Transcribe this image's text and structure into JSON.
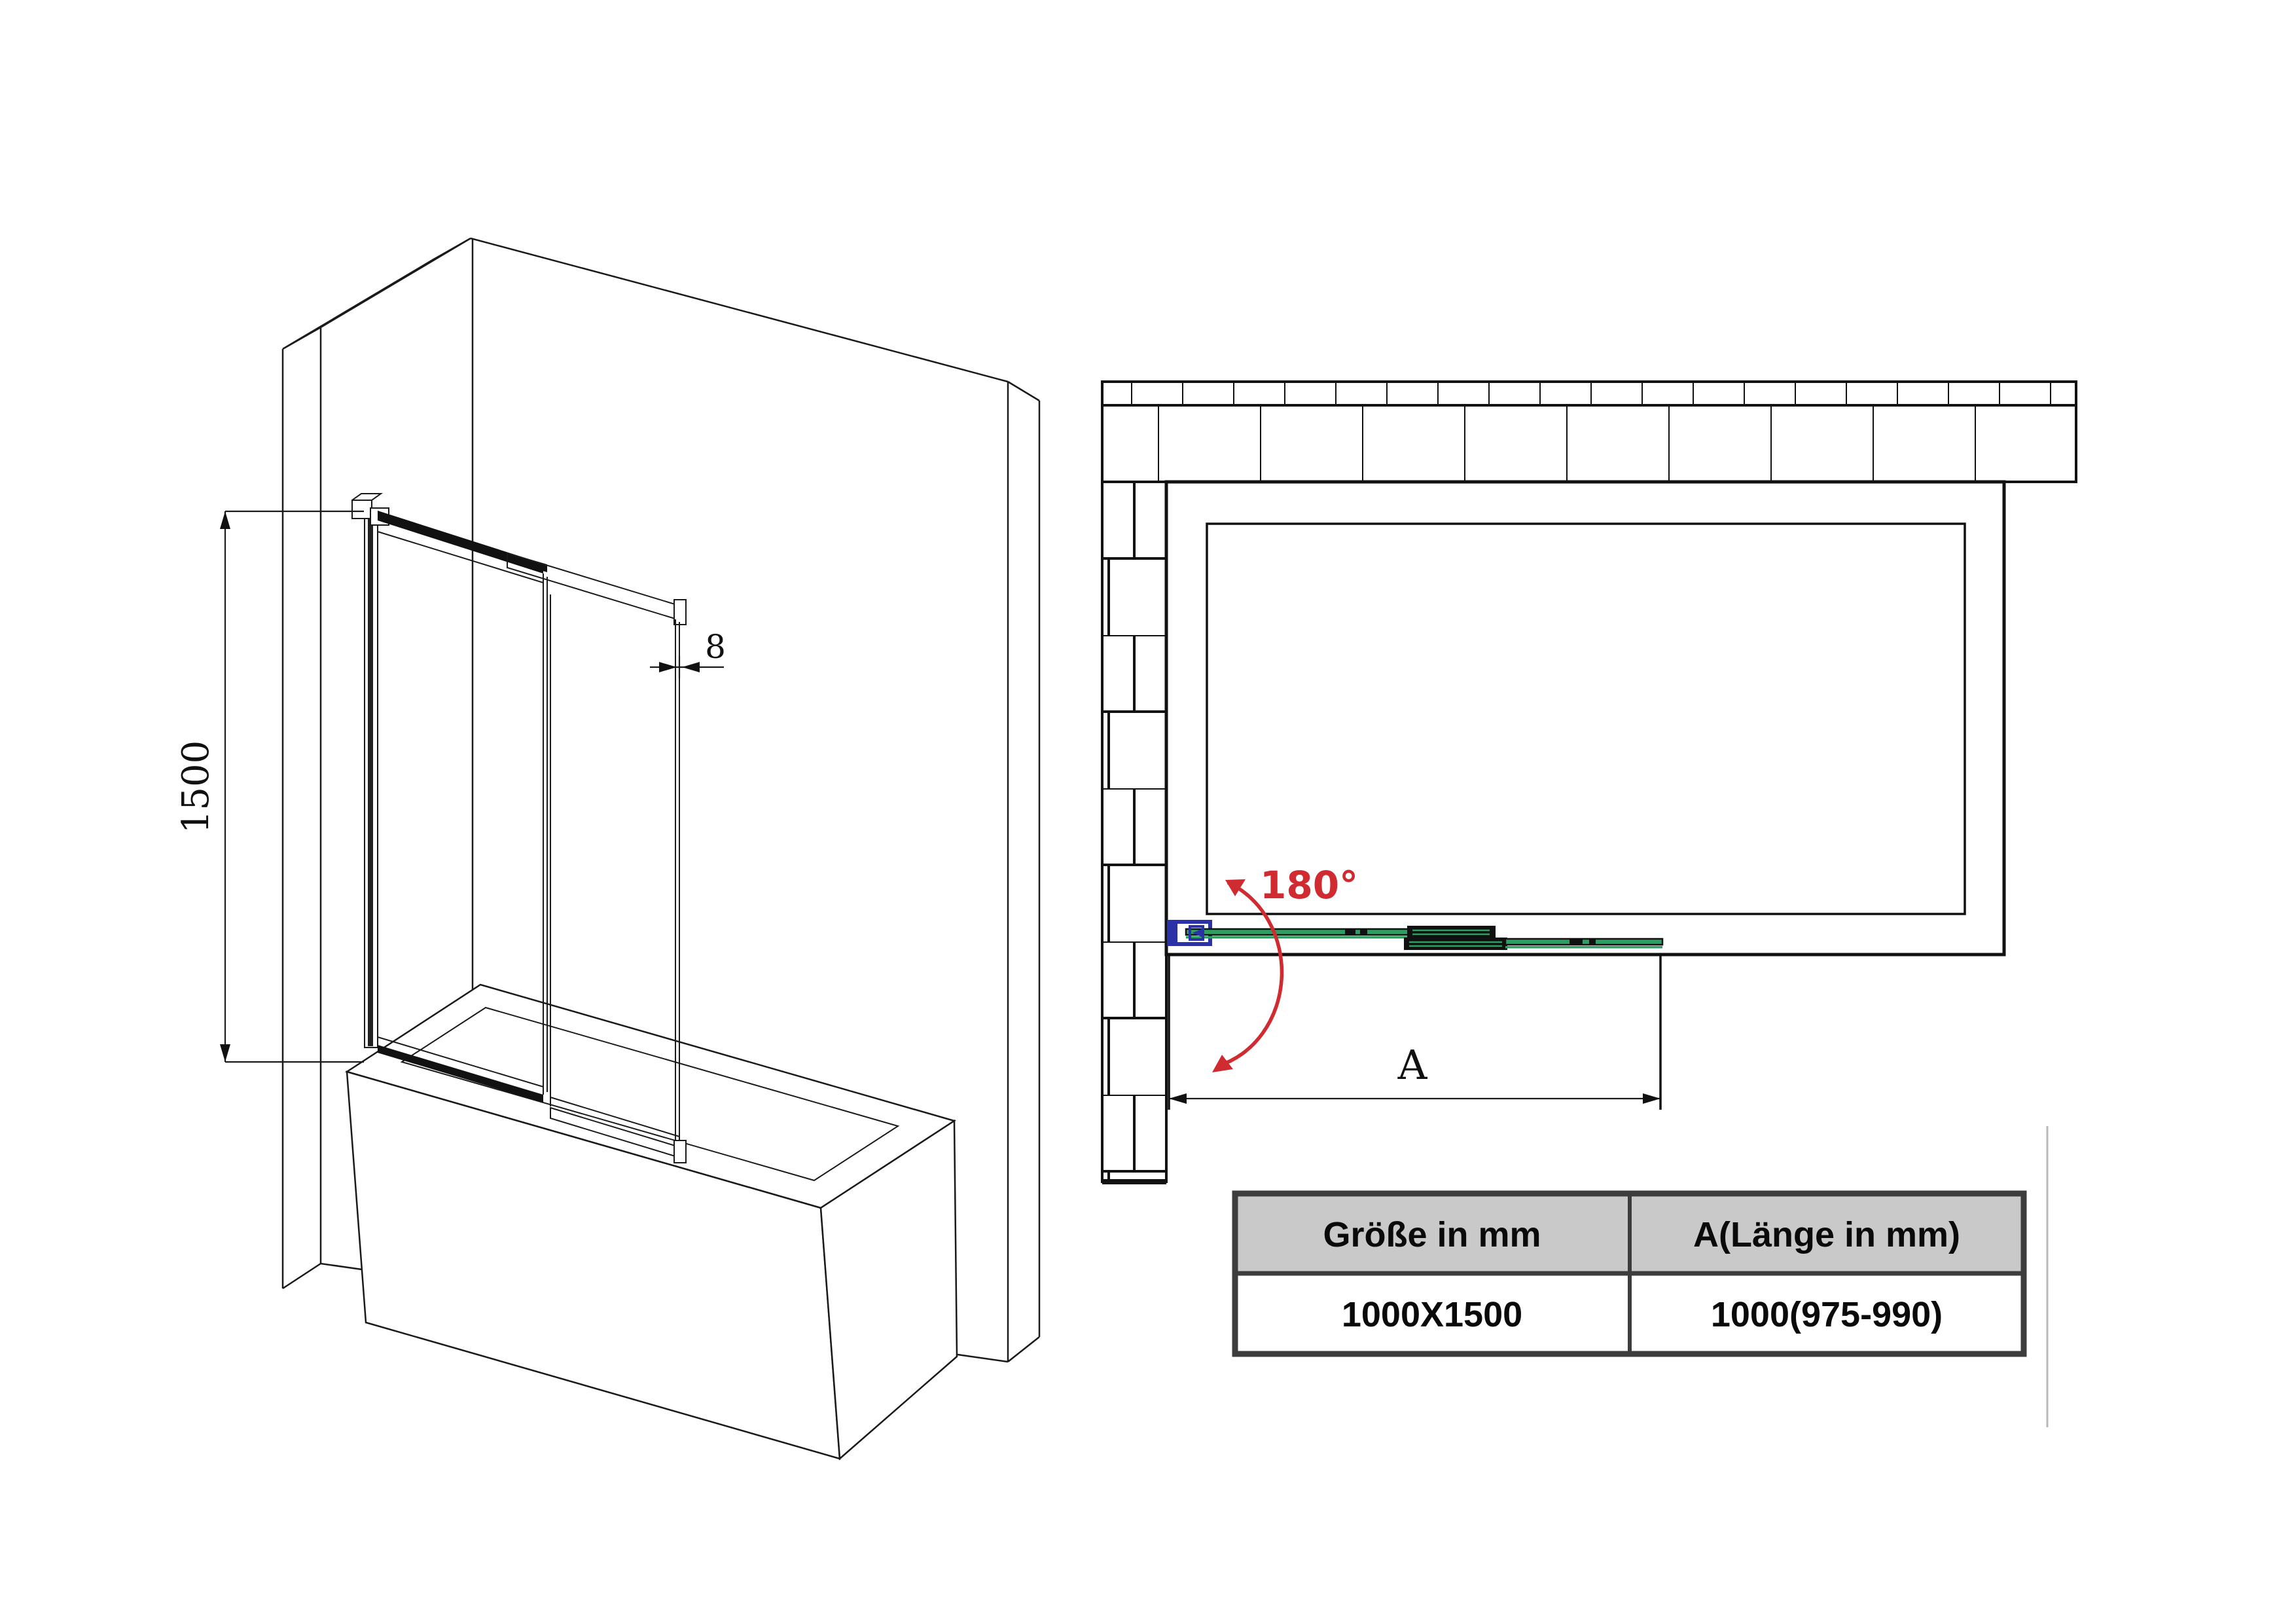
{
  "drawing": {
    "type": "shower-screen installation drawing",
    "views": [
      "isometric view",
      "top plan view",
      "size table"
    ]
  },
  "colors": {
    "glass_green": "#2f9e63",
    "bracket_blue": "#2b32a8",
    "annotation_red": "#cf2b31",
    "table_header_bg": "#c9c9c9",
    "table_border": "#3d3d3d",
    "line": "#1a1a1a"
  },
  "iso_view": {
    "height_dim": "1500",
    "glass_thickness_dim": "8"
  },
  "plan_view": {
    "swing_angle": "180°",
    "length_dim": "A"
  },
  "table": {
    "headers": [
      "Größe in mm",
      "A(Länge in mm)"
    ],
    "rows": [
      [
        "1000X1500",
        "1000(975-990)"
      ]
    ]
  }
}
